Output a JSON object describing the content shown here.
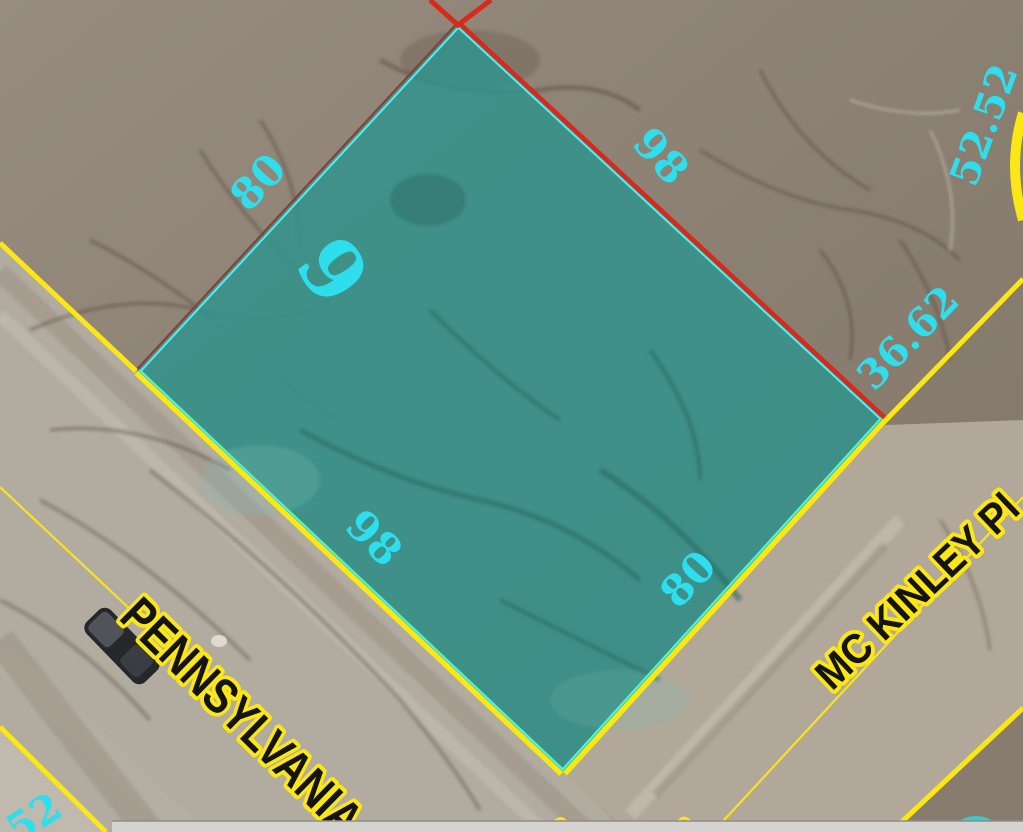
{
  "map": {
    "lot": {
      "number": "9"
    },
    "dimensions": {
      "top_left": "80",
      "top_right": "98",
      "bottom_left": "98",
      "bottom_right": "80",
      "right_segment": "36.62",
      "upper_right": "52.52",
      "corner_partial": "52"
    },
    "streets": {
      "pennsylvania": "PENNSYLVANIA",
      "mckinley": "MC KINLEY Pl"
    }
  },
  "colors": {
    "parcel-fill": "#31938c",
    "parcel-outline": "#54eef0",
    "edge-red": "#d8291d",
    "edge-maroon": "#7c463e",
    "line-yellow": "#fce716",
    "edge-green": "#3ee344",
    "label-cyan": "#2edeec",
    "street-text": "#141414",
    "terrain-brown": "#8e8274",
    "terrain-brown-dark": "#7e7264",
    "road-gray": "#b2aba0",
    "road-tan": "#b1a89a",
    "strip-gray": "#d5d3d0"
  }
}
